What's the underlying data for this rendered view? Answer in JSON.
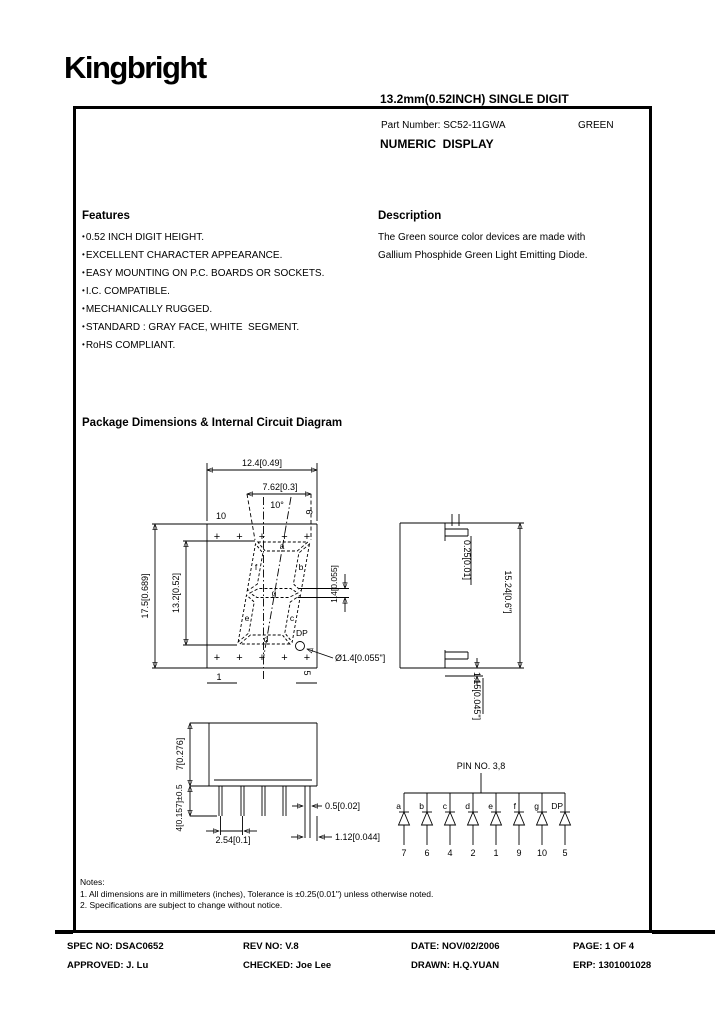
{
  "header": {
    "logo": "Kingbright",
    "title_line1": "13.2mm(0.52INCH) SINGLE DIGIT",
    "title_line2": "NUMERIC  DISPLAY"
  },
  "part": {
    "number_label": "Part Number: SC52-11GWA",
    "color": "GREEN"
  },
  "features": {
    "heading": "Features",
    "bullet": "•",
    "items": [
      "0.52 INCH DIGIT HEIGHT.",
      "EXCELLENT CHARACTER APPEARANCE.",
      "EASY MOUNTING ON P.C. BOARDS OR SOCKETS.",
      "I.C. COMPATIBLE.",
      "MECHANICALLY RUGGED.",
      "STANDARD : GRAY FACE, WHITE  SEGMENT.",
      "RoHS COMPLIANT."
    ]
  },
  "description": {
    "heading": "Description",
    "line1": "The Green source color devices are made with",
    "line2": "Gallium Phosphide Green Light Emitting Diode."
  },
  "package": {
    "heading": "Package Dimensions & Internal Circuit Diagram",
    "front": {
      "dim_width": "12.4[0.49]",
      "dim_char_width": "7.62[0.3]",
      "angle": "10°",
      "dim_height": "17.5[0.689]",
      "dim_char_height": "13.2[0.52]",
      "dim_seg_thickness": "1.4[0.055]",
      "dp_label": "DP",
      "dp_dim": "Ø1.4[0.055\"]",
      "pin_top_left": "10",
      "pin_top_right": "6",
      "pin_bottom_left": "1",
      "pin_bottom_right": "5",
      "plus_mark": "+",
      "seg_a": "a",
      "seg_b": "b",
      "seg_c": "c",
      "seg_d": "d",
      "seg_e": "e",
      "seg_f": "f",
      "seg_g": "g"
    },
    "side": {
      "dim_standoff": "0.25[0.01]",
      "dim_length": "15.24[0.6\"]",
      "dim_lead": "1.15[0.045\"]"
    },
    "profile": {
      "dim_body": "7[0.276]",
      "dim_lead_len": "4[0.157]±0.5",
      "dim_pitch": "2.54[0.1]",
      "dim_lead_w": "0.5[0.02]",
      "dim_lead_off": "1.12[0.044]"
    },
    "circuit": {
      "common_label": "PIN NO.  3,8",
      "segments": [
        "a",
        "b",
        "c",
        "d",
        "e",
        "f",
        "g",
        "DP"
      ],
      "pins": [
        "7",
        "6",
        "4",
        "2",
        "1",
        "9",
        "10",
        "5"
      ]
    }
  },
  "notes": {
    "heading": "Notes:",
    "items": [
      "1. All dimensions are in millimeters (inches), Tolerance is ±0.25(0.01\") unless otherwise noted.",
      "2. Specifications are subject  to change without notice."
    ]
  },
  "footer": {
    "spec": "SPEC NO: DSAC0652",
    "rev": "REV NO: V.8",
    "date": "DATE: NOV/02/2006",
    "page": "PAGE: 1 OF 4",
    "approved": "APPROVED: J. Lu",
    "checked": "CHECKED: Joe Lee",
    "drawn": "DRAWN: H.Q.YUAN",
    "erp": "ERP: 1301001028"
  }
}
